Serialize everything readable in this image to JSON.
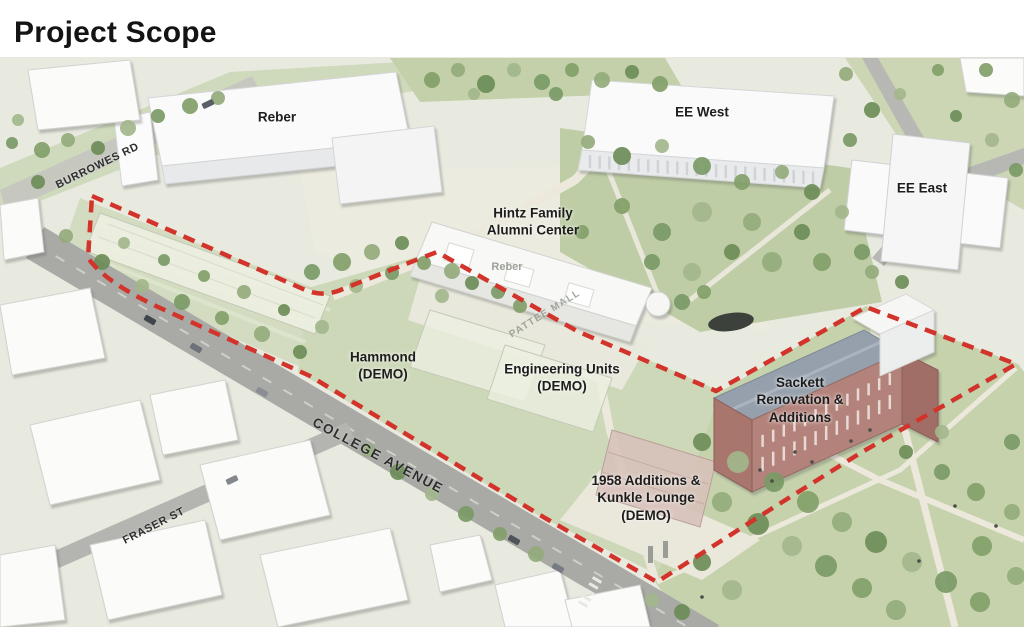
{
  "page": {
    "title": "Project Scope"
  },
  "map": {
    "building_labels": {
      "reber": "Reber",
      "ee_west": "EE West",
      "ee_east": "EE East",
      "hintz": "Hintz Family\nAlumni Center",
      "hammond": "Hammond\n(DEMO)",
      "engineering_units": "Engineering Units\n(DEMO)",
      "sackett": "Sackett\nRenovation &\nAdditions",
      "additions_1958": "1958 Additions &\nKunkle Lounge\n(DEMO)"
    },
    "street_labels": {
      "burrowes": "BURROWES RD",
      "college": "COLLEGE AVENUE",
      "fraser": "FRASER ST",
      "pattee": "PATTEE MALL"
    },
    "ghost_labels": {
      "reber_bg": "Reber"
    },
    "boundary": {
      "color": "#d2342b",
      "style": "dashed"
    }
  }
}
